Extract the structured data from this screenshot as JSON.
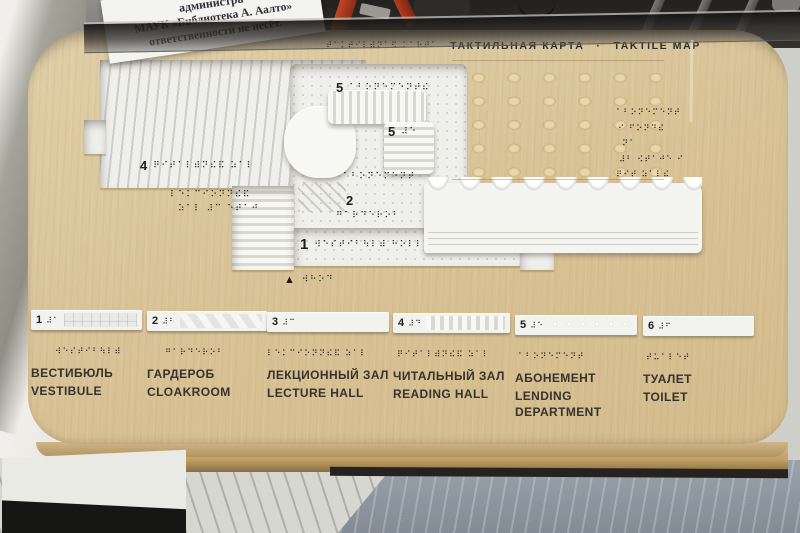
{
  "scene": {
    "sign": {
      "lines": [
        "администра",
        "МАУК «Библиотека А. Аалто»",
        "ответственности не несёт."
      ]
    },
    "colors": {
      "board_wood": "#d9c498",
      "model_white": "#f2f2ef",
      "ink": "#2b2a26",
      "paper": "#f3f3ef",
      "red_object": "#b23420",
      "floor_right": "#8f98a2"
    }
  },
  "title": {
    "braille": "⠞⠁⠅⠞⠊⠇⠾⠝⠁⠫ ⠅⠁⠗⠞⠁",
    "ru": "ТАКТИЛЬНАЯ КАРТА",
    "separator": "·",
    "en": "TAKTILE MAP"
  },
  "map": {
    "room5_top": {
      "num": "5",
      "braille": "⠁⠃⠕⠝⠑⠍⠑⠝⠞⠮"
    },
    "room5_side": {
      "num": "5",
      "braille": "⠼⠑"
    },
    "mid_braille": "⠁⠃⠕⠝⠑⠍⠑⠝⠞",
    "room4": {
      "num": "4",
      "braille": "⠟⠊⠞⠁⠇⠾⠝⠮⠯ ⠵⠁⠇"
    },
    "room2": {
      "num": "2",
      "braille": "⠛⠁⠗⠙⠑⠗⠕⠃"
    },
    "room1": {
      "num": "1",
      "braille": "⠺⠑⠎⠞⠊⠃⠳⠇⠾ ⠓⠕⠇⠇"
    },
    "entrance": {
      "glyph": "▲",
      "braille": "⠺⠓⠕⠙"
    },
    "wood_braille": [
      "⠇⠑⠅⠉⠊⠕⠝⠝⠮⠯",
      "⠵⠁⠇ ⠼⠉ ⠑⠞⠁⠚"
    ],
    "right_braille": [
      "⠁⠃⠕⠝⠑⠍⠑⠝⠞",
      "⠊ ⠋⠕⠝⠙⠮",
      "⠝⠁",
      "⠼⠃ ⠪⠞⠁⠚⠑ ⠊",
      "⠟⠊⠞ ⠵⠁⠇⠮"
    ]
  },
  "legend": {
    "items": [
      {
        "num": "1",
        "bar_braille": "⠼⠁",
        "braille": "⠺⠑⠎⠞⠊⠃⠳⠇⠾",
        "ru": "ВЕСТИБЮЛЬ",
        "en": "VESTIBULE"
      },
      {
        "num": "2",
        "bar_braille": "⠼⠃",
        "braille": "⠛⠁⠗⠙⠑⠗⠕⠃",
        "ru": "ГАРДЕРОБ",
        "en": "CLOAKROOM"
      },
      {
        "num": "3",
        "bar_braille": "⠼⠉",
        "braille": "⠇⠑⠅⠉⠊⠕⠝⠝⠮⠯ ⠵⠁⠇",
        "ru": "ЛЕКЦИОННЫЙ ЗАЛ",
        "en": "LECTURE HALL"
      },
      {
        "num": "4",
        "bar_braille": "⠼⠙",
        "braille": "⠟⠊⠞⠁⠇⠾⠝⠮⠯ ⠵⠁⠇",
        "ru": "ЧИТАЛЬНЫЙ ЗАЛ",
        "en": "READING HALL"
      },
      {
        "num": "5",
        "bar_braille": "⠼⠑",
        "braille": "⠁⠃⠕⠝⠑⠍⠑⠝⠞",
        "ru": "АБОНЕМЕНТ",
        "en": "LENDING DEPARTMENT"
      },
      {
        "num": "6",
        "bar_braille": "⠼⠋",
        "braille": "⠞⠥⠁⠇⠑⠞",
        "ru": "ТУАЛЕТ",
        "en": "TOILET"
      }
    ]
  }
}
